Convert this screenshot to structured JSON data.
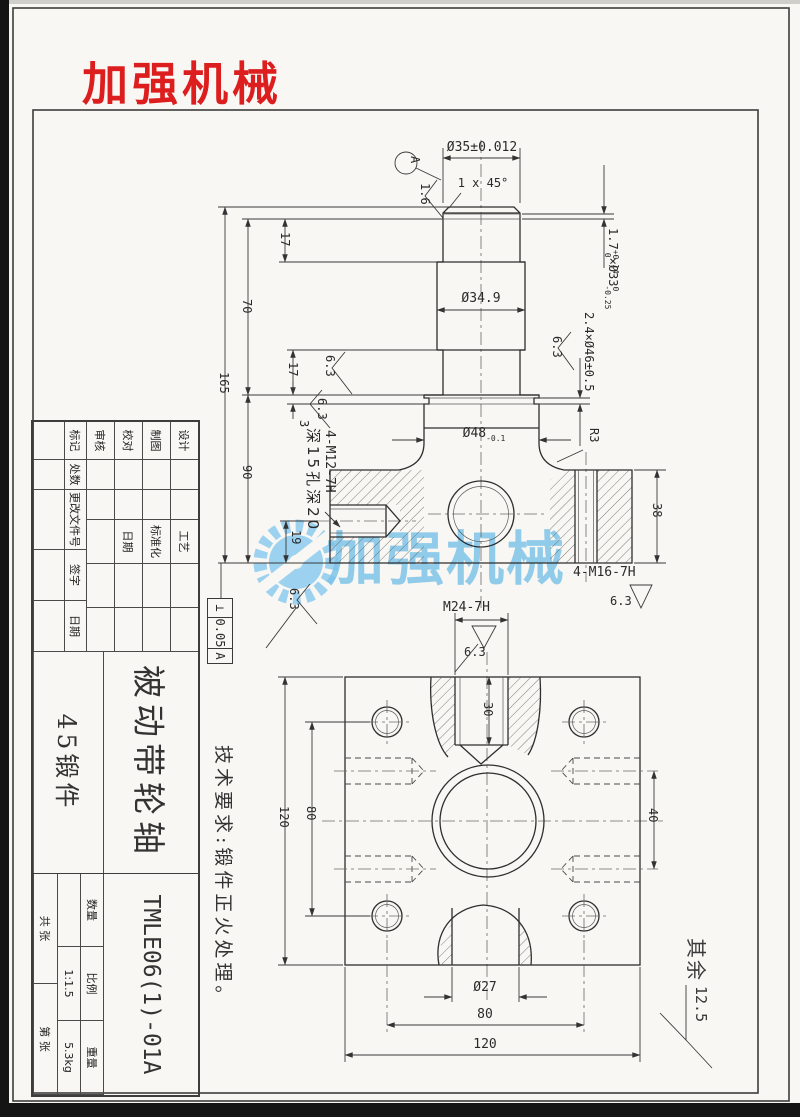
{
  "logo": {
    "text": "加强机械"
  },
  "watermark": {
    "text": "加强机械"
  },
  "front": {
    "dia35": "Ø35±0.012",
    "chamfer": "1 x 45°",
    "datum": "A",
    "ra16": "1.6",
    "ra63": "6.3",
    "d17a": "17",
    "d70": "70",
    "d165": "165",
    "d17b": "17",
    "d3": "3",
    "d90": "90",
    "d19": "19",
    "d38": "38",
    "dia349": "Ø34.9",
    "groove1": {
      "v": "1.7",
      "up": "+0.14",
      "dn": "0",
      "d": "×Ø33",
      "dup": "0",
      "ddn": "-0.25"
    },
    "groove2": "2.4×Ø46±0.5",
    "dia48": {
      "v": "Ø48",
      "dn": "-0.1"
    },
    "r3": "R3",
    "m16": "4-M16-7H",
    "m12": "4-M12-7H",
    "m12_note": "深15孔深20"
  },
  "tolerance_frame": {
    "symbol": "⊥",
    "value": "0.05",
    "datum": "A"
  },
  "plan": {
    "m24": "M24-7H",
    "ra63": "6.3",
    "d30": "30",
    "d120_left": "120",
    "d80_left": "80",
    "d40": "40",
    "dia27": "Ø27",
    "d80_bottom": "80",
    "d120_bottom": "120"
  },
  "tech_note": "技术要求:锻件正火处理。",
  "other_roughness": {
    "prefix": "其余",
    "value": "12.5"
  },
  "title_block": {
    "rev_headers": [
      "标记",
      "处数",
      "更改文件号",
      "签字",
      "日期"
    ],
    "sign_rows": [
      "设计",
      "制图",
      "校对",
      "审核"
    ],
    "proc_rows": [
      "工艺",
      "标准化",
      "日期"
    ],
    "part_name": "被动带轮轴",
    "material": "45锻件",
    "drawing_no": "TMLE06(1)-01A",
    "qty_label": "数量",
    "scale_label": "比例",
    "scale_value": "1:1.5",
    "weight_label": "重量",
    "weight_value": "5.3kg",
    "sheet_label": "共  张",
    "page_label": "第  张"
  }
}
